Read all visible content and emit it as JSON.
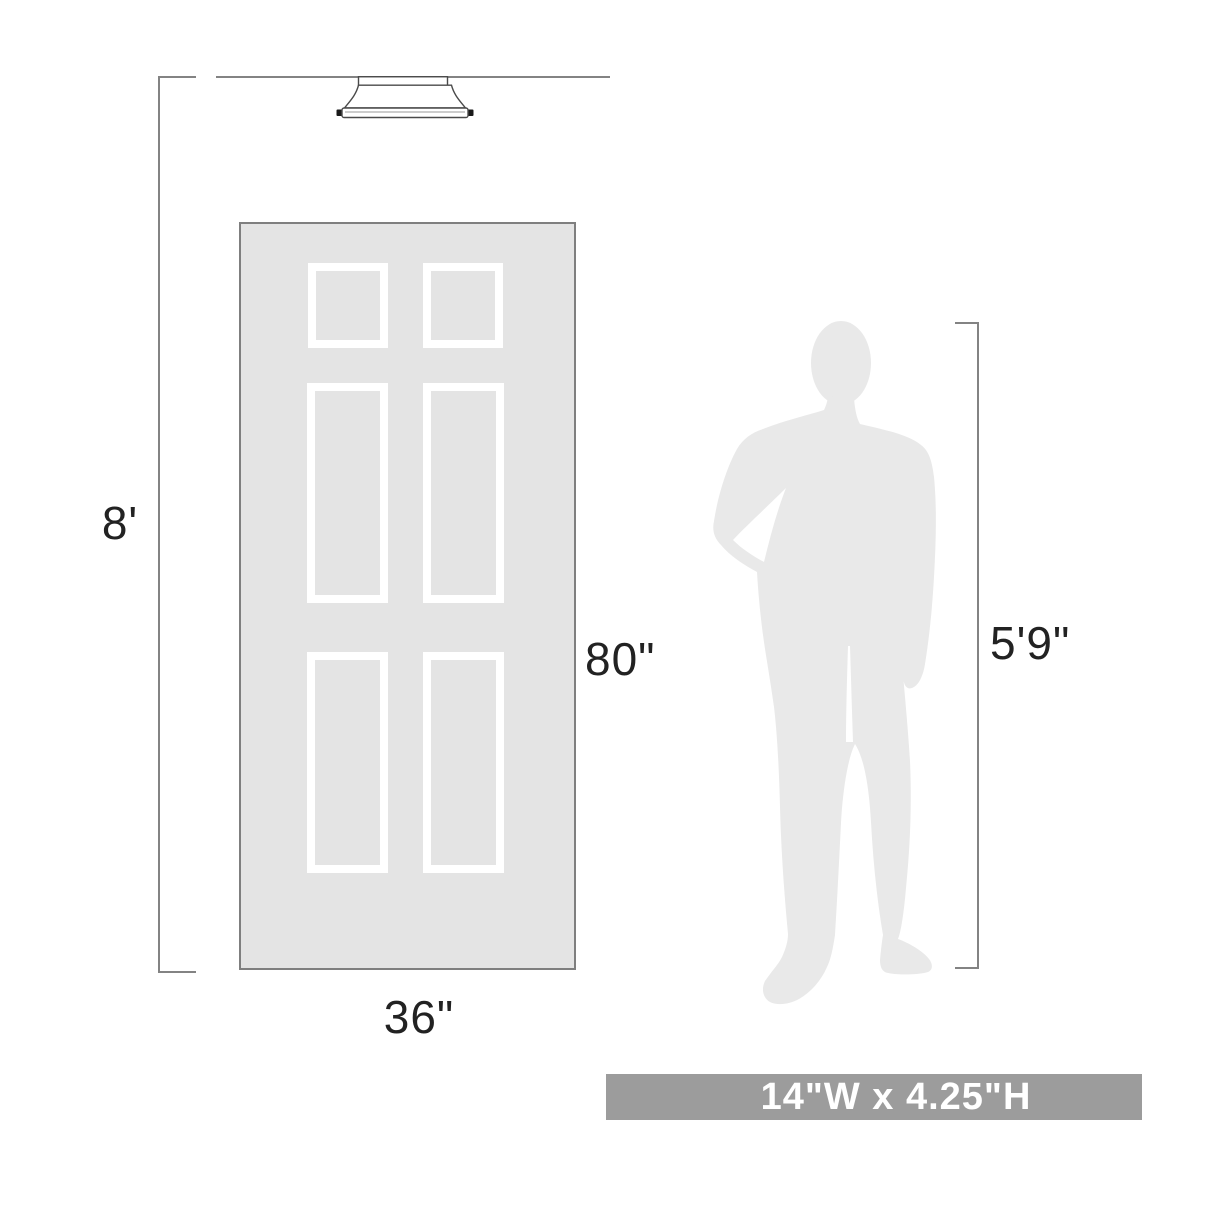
{
  "scale_diagram": {
    "ceiling": {
      "height_label": "8'"
    },
    "door": {
      "height_label": "80\"",
      "width_label": "36\""
    },
    "person": {
      "height_label": "5'9\""
    },
    "banner": {
      "size_label": "14\"W x 4.25\"H"
    },
    "icons": {
      "fixture": "flush-mount-ceiling-light-icon",
      "door": "six-panel-door-illustration",
      "person": "man-silhouette"
    },
    "colors": {
      "background": "#ffffff",
      "door_fill": "#e4e4e4",
      "panel_frame": "#ffffff",
      "person_fill": "#e9e9e9",
      "dimension_line": "#838383",
      "fixture_outline": "#4a4a4a",
      "label_text": "#222222",
      "banner_bg": "#9c9c9c",
      "banner_text": "#ffffff"
    }
  }
}
